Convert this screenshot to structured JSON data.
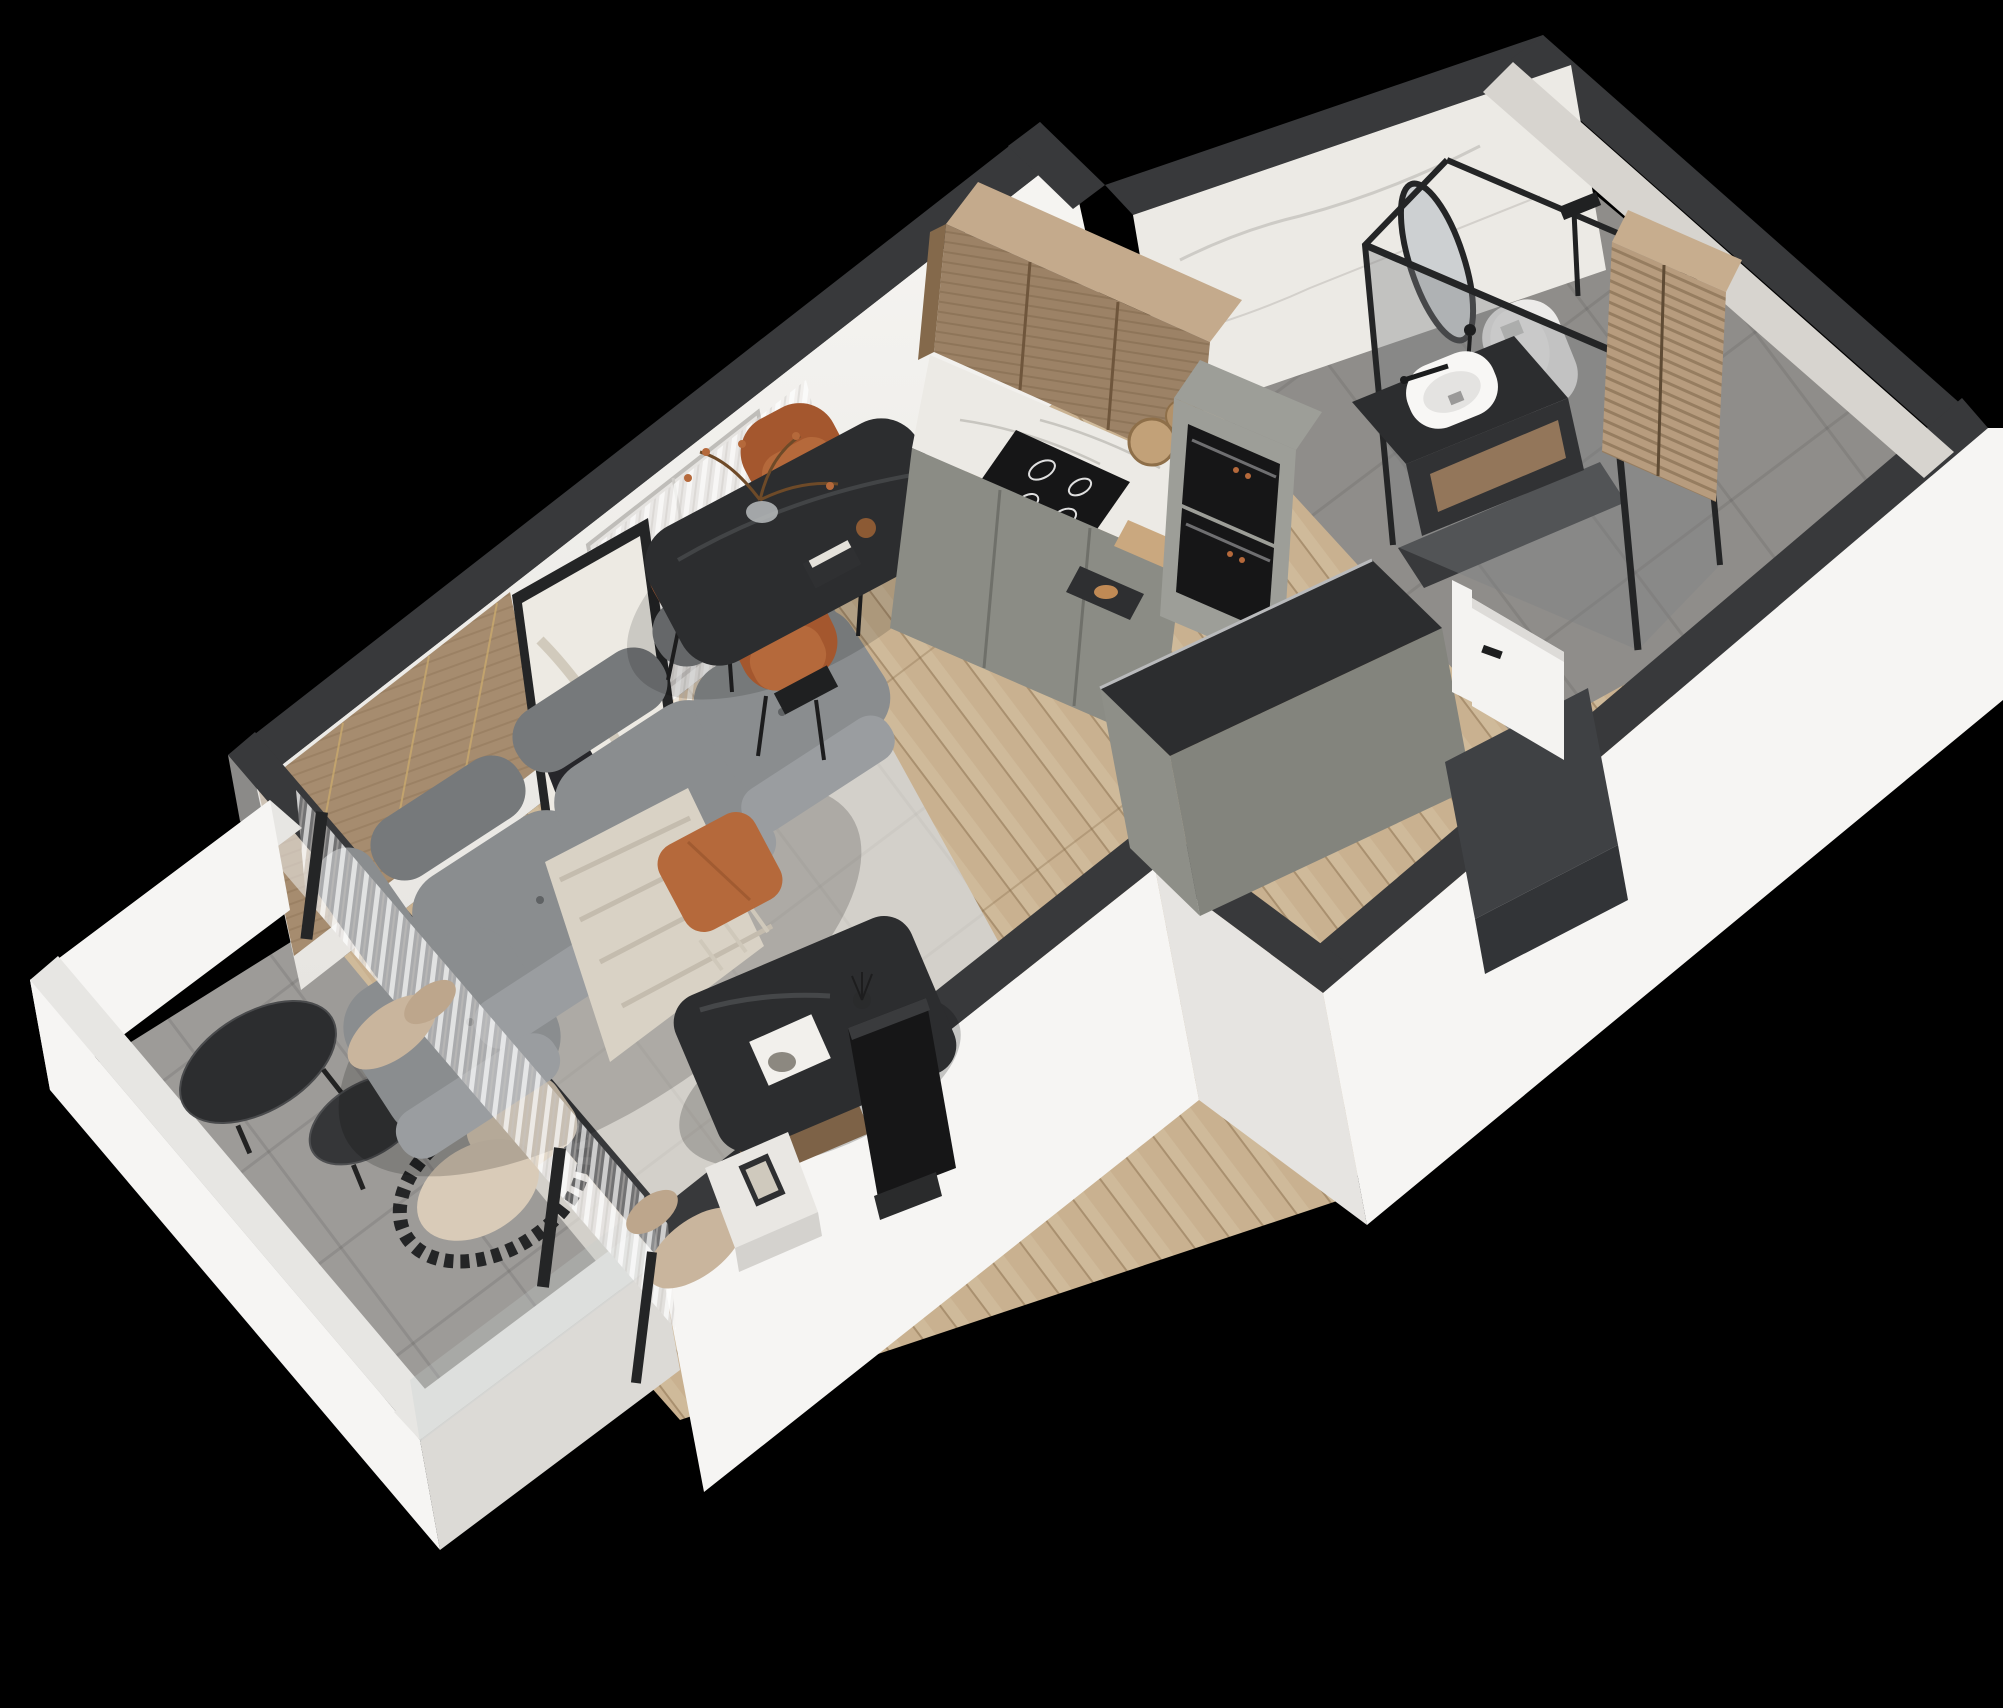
{
  "title": "isometric-3d-floor-plan-render-studio-apartment",
  "palette": {
    "bg": "#000000",
    "wall_top": "#38393b",
    "wall_face": "#f3f2ef",
    "wall_face_shade": "#e6e4e1",
    "parapet_top": "#e7e6e3",
    "parapet_face": "#f6f5f3",
    "parapet_face_shade": "#dcdad6",
    "wood_floor": "#c9b190",
    "wood_floor_light": "#d8c5a7",
    "rug": "#d3d0ca",
    "tile_balcony": "#9d9b98",
    "tile_bath": "#8f8d8a",
    "wood_panel": "#a68c6f",
    "wood_cabinet": "#9c8266",
    "wood_cabinet_top": "#c4aa8c",
    "marble": "#eceae5",
    "cabinet_gray": "#8b8c85",
    "cabinet_gray_light": "#9d9e98",
    "counter_dark": "#2c2d2f",
    "appliance_black": "#161617",
    "sofa_dark": "#76797b",
    "sofa_mid": "#8a8d8f",
    "sofa_light": "#9a9da0",
    "accent_orange": "#b5693b",
    "accent_orange_dark": "#a4572e",
    "blanket_beige": "#d9d2c5",
    "cushion_beige": "#ddcfba",
    "fixture_white": "#f8f7f5",
    "glass_tint": "#7d8284",
    "frame_black": "#242526",
    "door_white": "#f4f3f1",
    "closet_dark": "#3f4144",
    "mosaic_tile": "#d7d4cf",
    "art_paper": "#edeae3",
    "art_dark": "#26262a",
    "louver_wood": "#b79c7e"
  },
  "scene": {
    "type": "3d-isometric-apartment-cutaway",
    "background": "black",
    "rooms": [
      {
        "name": "living-room",
        "floor": "wood planks + gray rug",
        "furniture": [
          "gray-modular-tufted-sofa",
          "orange-throw-pillow",
          "beige-throw-blanket",
          "leaning-abstract-artwork",
          "wood-slat-accent-wall",
          "sheer-curtains",
          "window",
          "dark-coffee-table",
          "magazine",
          "reed-diffuser",
          "white-side-table",
          "tv-screen"
        ]
      },
      {
        "name": "dining-area",
        "floor": "wood planks",
        "furniture": [
          "black-dining-table",
          "orange-velvet-chair-x4",
          "branch-vase-decor",
          "books",
          "glass"
        ]
      },
      {
        "name": "kitchen",
        "floor": "wood planks",
        "furniture": [
          "wood-upper-cabinets",
          "marble-backsplash-counter",
          "induction-cooktop",
          "gray-base-cabinets",
          "tall-oven-column",
          "double-built-in-ovens",
          "cutting-boards",
          "gray-peninsula-island-dark-top"
        ]
      },
      {
        "name": "hallway-entry",
        "floor": "wood planks",
        "furniture": [
          "white-interior-door-open",
          "dark-entry-wardrobe"
        ]
      },
      {
        "name": "bathroom",
        "floor": "gray tile",
        "furniture": [
          "oval-black-frame-mirror",
          "black-vanity-wood-drawer",
          "white-vessel-sink",
          "black-faucet",
          "glass-shower-enclosure-black-frame",
          "shower-head",
          "toilet",
          "louvered-wood-cabinet",
          "marble-feature-wall",
          "mosaic-wall"
        ]
      },
      {
        "name": "balcony",
        "floor": "gray tile",
        "furniture": [
          "black-round-nesting-tables-x2",
          "black-slatted-lounge-chair-beige-cushions",
          "glass-balcony-door-black-frame",
          "sheer-curtains"
        ]
      }
    ]
  }
}
